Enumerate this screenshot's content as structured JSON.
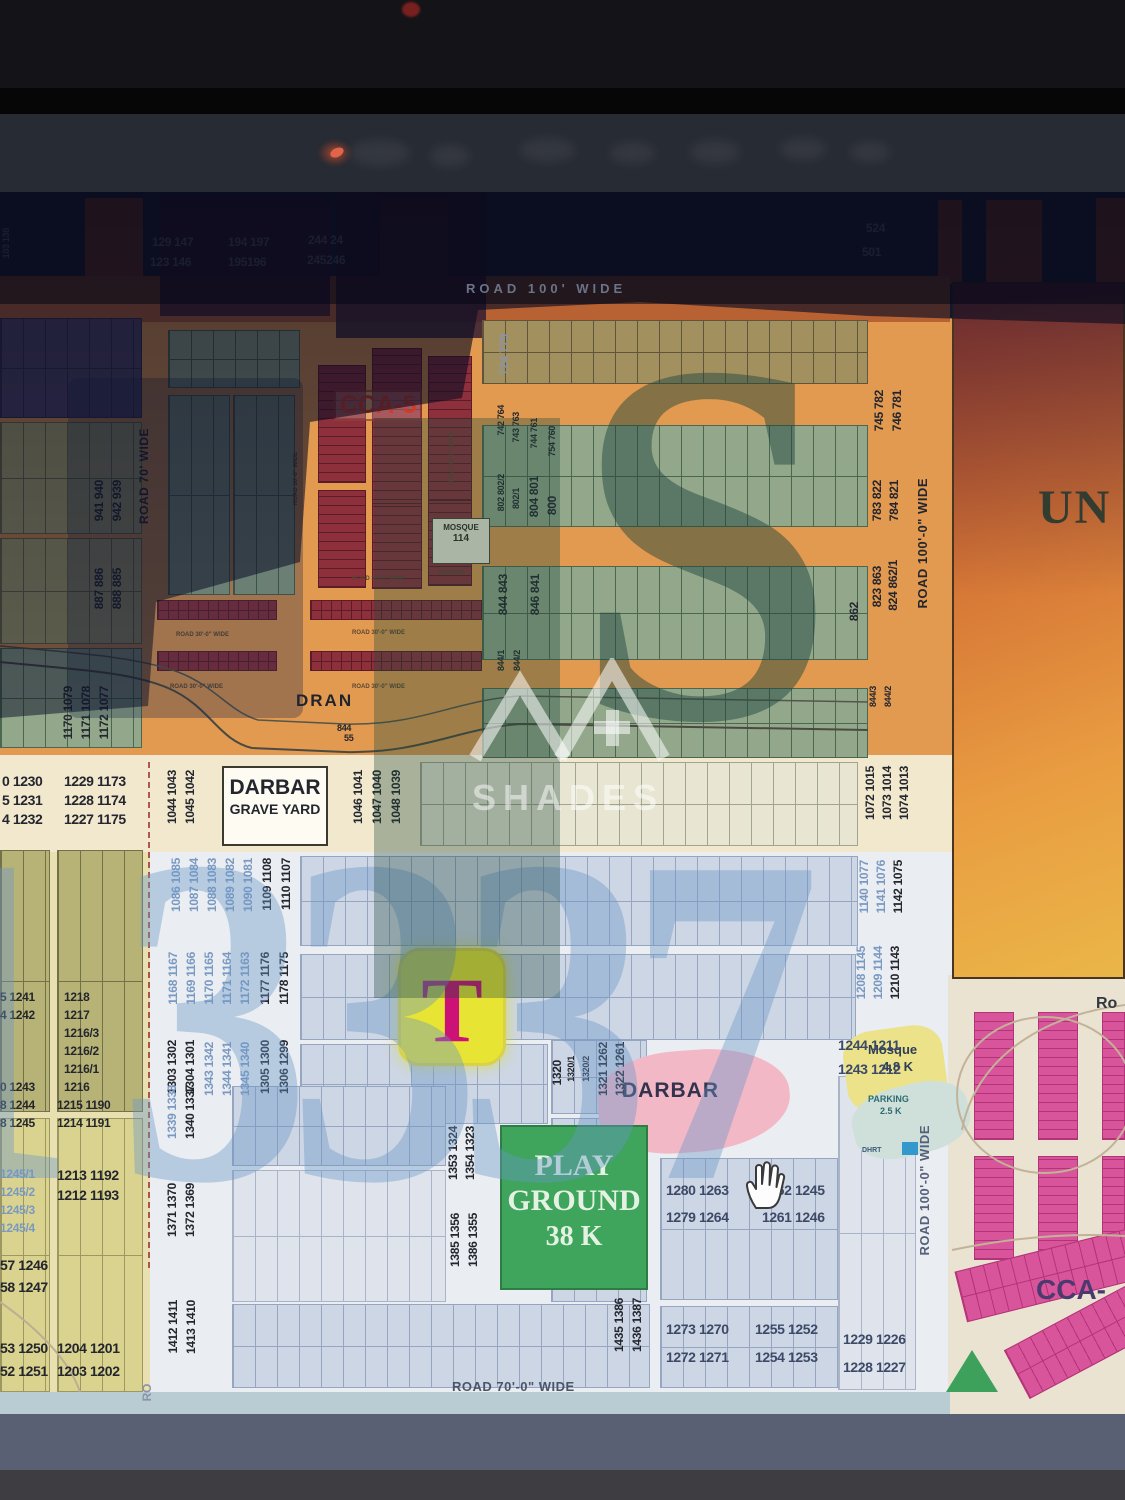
{
  "map": {
    "areas": {
      "cca5": "CCA-5",
      "darbar_box_title": "DARBAR",
      "darbar_box_sub": "GRAVE YARD",
      "dran": "DRAN",
      "playground_l1": "PLAY",
      "playground_l2": "GROUND",
      "playground_l3": "38 K",
      "darbar": "DARBAR",
      "mosque_l1": "Mosque",
      "mosque_l2": "4.8 K",
      "parking_l1": "PARKING",
      "parking_l2": "2.5 K",
      "dhrt": "DHRT",
      "mosque_box_l1": "MOSQUE",
      "mosque_box_l2": "114",
      "mosque_box_sub": "PARKING",
      "un_block": "UN",
      "cca_bottom_right": "CCA-",
      "ro": "Ro",
      "t_marker": "T",
      "small_844": "844",
      "small_55": "55"
    },
    "roads": {
      "top": "ROAD 100' WIDE",
      "left_v": "ROAD 70' WIDE",
      "right_v_upper": "ROAD 100'-0\" WIDE",
      "right_v_lower": "ROAD 100'-0\" WIDE",
      "bottom": "ROAD 70'-0\" WIDE",
      "minor": "ROAD 30'-0\" WIDE"
    },
    "watermark": {
      "big_letter": "S",
      "digits": [
        "1",
        "3",
        "3",
        "3",
        "7"
      ],
      "brand": "SHADES"
    },
    "plot_labels": [
      {
        "t": "129 147",
        "x": 152,
        "y": 236,
        "k": "g"
      },
      {
        "t": "123 146",
        "x": 150,
        "y": 256,
        "k": "g"
      },
      {
        "t": "194 197",
        "x": 228,
        "y": 236,
        "k": "g"
      },
      {
        "t": "195196",
        "x": 228,
        "y": 256,
        "k": "g"
      },
      {
        "t": "244 24",
        "x": 308,
        "y": 234,
        "k": "g"
      },
      {
        "t": "245246",
        "x": 307,
        "y": 254,
        "k": "g"
      },
      {
        "t": "524",
        "x": 866,
        "y": 222,
        "k": "g"
      },
      {
        "t": "501",
        "x": 862,
        "y": 246,
        "k": "g"
      },
      {
        "t": "103 138",
        "x": 2,
        "y": 228,
        "k": "g v S"
      },
      {
        "t": "724 779",
        "x": 498,
        "y": 334,
        "k": "v g"
      },
      {
        "t": "742 764",
        "x": 497,
        "y": 405,
        "k": "v S"
      },
      {
        "t": "743 763",
        "x": 512,
        "y": 412,
        "k": "v S"
      },
      {
        "t": "744 761",
        "x": 530,
        "y": 418,
        "k": "v S"
      },
      {
        "t": "754 760",
        "x": 548,
        "y": 426,
        "k": "v S"
      },
      {
        "t": "745 782",
        "x": 873,
        "y": 390,
        "k": "v"
      },
      {
        "t": "746 781",
        "x": 891,
        "y": 390,
        "k": "v"
      },
      {
        "t": "802 802/2",
        "x": 497,
        "y": 474,
        "k": "v S"
      },
      {
        "t": "802/1",
        "x": 512,
        "y": 488,
        "k": "v S"
      },
      {
        "t": "804 801",
        "x": 528,
        "y": 476,
        "k": "v"
      },
      {
        "t": "800",
        "x": 546,
        "y": 496,
        "k": "v"
      },
      {
        "t": "783 822",
        "x": 871,
        "y": 480,
        "k": "v"
      },
      {
        "t": "784 821",
        "x": 888,
        "y": 480,
        "k": "v"
      },
      {
        "t": "823 863",
        "x": 871,
        "y": 566,
        "k": "v"
      },
      {
        "t": "824 862/1",
        "x": 887,
        "y": 560,
        "k": "v"
      },
      {
        "t": "862",
        "x": 848,
        "y": 602,
        "k": "v"
      },
      {
        "t": "844 843",
        "x": 497,
        "y": 574,
        "k": "v"
      },
      {
        "t": "846 841",
        "x": 529,
        "y": 574,
        "k": "v"
      },
      {
        "t": "844/1",
        "x": 497,
        "y": 650,
        "k": "v S"
      },
      {
        "t": "844/2",
        "x": 513,
        "y": 650,
        "k": "v S"
      },
      {
        "t": "844/3",
        "x": 869,
        "y": 686,
        "k": "v S"
      },
      {
        "t": "844/2",
        "x": 884,
        "y": 686,
        "k": "v S"
      },
      {
        "t": "941 940",
        "x": 93,
        "y": 480,
        "k": "v"
      },
      {
        "t": "942 939",
        "x": 111,
        "y": 480,
        "k": "v"
      },
      {
        "t": "887 886",
        "x": 93,
        "y": 568,
        "k": "v"
      },
      {
        "t": "888 885",
        "x": 111,
        "y": 568,
        "k": "v"
      },
      {
        "t": "1170 1079",
        "x": 62,
        "y": 686,
        "k": "v"
      },
      {
        "t": "1171 1078",
        "x": 80,
        "y": 686,
        "k": "v"
      },
      {
        "t": "1172 1077",
        "x": 98,
        "y": 686,
        "k": "v"
      },
      {
        "t": "1044 1043",
        "x": 166,
        "y": 770,
        "k": "v"
      },
      {
        "t": "1045 1042",
        "x": 184,
        "y": 770,
        "k": "v"
      },
      {
        "t": "1046 1041",
        "x": 352,
        "y": 770,
        "k": "v"
      },
      {
        "t": "1047 1040",
        "x": 371,
        "y": 770,
        "k": "v"
      },
      {
        "t": "1048 1039",
        "x": 390,
        "y": 770,
        "k": "v"
      },
      {
        "t": "1072 1015",
        "x": 864,
        "y": 766,
        "k": "v"
      },
      {
        "t": "1073 1014",
        "x": 881,
        "y": 766,
        "k": "v"
      },
      {
        "t": "1074 1013",
        "x": 898,
        "y": 766,
        "k": "v"
      },
      {
        "t": "844",
        "x": 337,
        "y": 724,
        "k": "S"
      },
      {
        "t": "55",
        "x": 344,
        "y": 734,
        "k": "S"
      },
      {
        "t": "0 1230",
        "x": 2,
        "y": 774,
        "k": "L"
      },
      {
        "t": "5 1231",
        "x": 2,
        "y": 793,
        "k": "L"
      },
      {
        "t": "4 1232",
        "x": 2,
        "y": 812,
        "k": "L"
      },
      {
        "t": "1229 1173",
        "x": 64,
        "y": 774,
        "k": "L"
      },
      {
        "t": "1228 1174",
        "x": 64,
        "y": 793,
        "k": "L"
      },
      {
        "t": "1227 1175",
        "x": 64,
        "y": 812,
        "k": "L"
      },
      {
        "t": "1086 1085",
        "x": 170,
        "y": 858,
        "k": "v numb"
      },
      {
        "t": "1087 1084",
        "x": 188,
        "y": 858,
        "k": "v numb"
      },
      {
        "t": "1088 1083",
        "x": 206,
        "y": 858,
        "k": "v numb"
      },
      {
        "t": "1089 1082",
        "x": 224,
        "y": 858,
        "k": "v numb"
      },
      {
        "t": "1090 1081",
        "x": 242,
        "y": 858,
        "k": "v numb"
      },
      {
        "t": "1109 1108",
        "x": 261,
        "y": 858,
        "k": "v"
      },
      {
        "t": "1110 1107",
        "x": 280,
        "y": 858,
        "k": "v"
      },
      {
        "t": "1140 1077",
        "x": 858,
        "y": 860,
        "k": "v numb"
      },
      {
        "t": "1141 1076",
        "x": 875,
        "y": 860,
        "k": "v numb"
      },
      {
        "t": "1142 1075",
        "x": 892,
        "y": 860,
        "k": "v"
      },
      {
        "t": "1168 1167",
        "x": 167,
        "y": 952,
        "k": "v numb"
      },
      {
        "t": "1169 1166",
        "x": 185,
        "y": 952,
        "k": "v numb"
      },
      {
        "t": "1170 1165",
        "x": 203,
        "y": 952,
        "k": "v numb"
      },
      {
        "t": "1171 1164",
        "x": 221,
        "y": 952,
        "k": "v numb"
      },
      {
        "t": "1172 1163",
        "x": 239,
        "y": 952,
        "k": "v numb"
      },
      {
        "t": "1177 1176",
        "x": 259,
        "y": 952,
        "k": "v"
      },
      {
        "t": "1178 1175",
        "x": 278,
        "y": 952,
        "k": "v"
      },
      {
        "t": "1208 1145",
        "x": 855,
        "y": 946,
        "k": "v numb"
      },
      {
        "t": "1209 1144",
        "x": 872,
        "y": 946,
        "k": "v numb"
      },
      {
        "t": "1210 1143",
        "x": 889,
        "y": 946,
        "k": "v"
      },
      {
        "t": "1303 1302",
        "x": 166,
        "y": 1040,
        "k": "v"
      },
      {
        "t": "1304 1301",
        "x": 184,
        "y": 1040,
        "k": "v"
      },
      {
        "t": "1343 1342",
        "x": 203,
        "y": 1042,
        "k": "v numb"
      },
      {
        "t": "1344 1341",
        "x": 221,
        "y": 1042,
        "k": "v numb"
      },
      {
        "t": "1345 1340",
        "x": 239,
        "y": 1042,
        "k": "v numb"
      },
      {
        "t": "1305 1300",
        "x": 259,
        "y": 1040,
        "k": "v"
      },
      {
        "t": "1306 1299",
        "x": 278,
        "y": 1040,
        "k": "v"
      },
      {
        "t": "1320",
        "x": 551,
        "y": 1060,
        "k": "v"
      },
      {
        "t": "1320/1",
        "x": 567,
        "y": 1056,
        "k": "v S"
      },
      {
        "t": "1320/2",
        "x": 582,
        "y": 1056,
        "k": "v S"
      },
      {
        "t": "1321 1262",
        "x": 597,
        "y": 1042,
        "k": "v"
      },
      {
        "t": "1322 1261",
        "x": 614,
        "y": 1042,
        "k": "v"
      },
      {
        "t": "1244 1211",
        "x": 838,
        "y": 1038,
        "k": "s L"
      },
      {
        "t": "1243 1212",
        "x": 838,
        "y": 1062,
        "k": "s L"
      },
      {
        "t": "1339 1338",
        "x": 166,
        "y": 1085,
        "k": "v numb"
      },
      {
        "t": "1340 1337",
        "x": 184,
        "y": 1085,
        "k": "v"
      },
      {
        "t": "1353 1324",
        "x": 447,
        "y": 1126,
        "k": "v"
      },
      {
        "t": "1354 1323",
        "x": 464,
        "y": 1126,
        "k": "v"
      },
      {
        "t": "1280 1263",
        "x": 666,
        "y": 1183,
        "k": "s L"
      },
      {
        "t": "1279 1264",
        "x": 666,
        "y": 1210,
        "k": "s L"
      },
      {
        "t": "1262 1245",
        "x": 762,
        "y": 1183,
        "k": "s L"
      },
      {
        "t": "1261 1246",
        "x": 762,
        "y": 1210,
        "k": "s L"
      },
      {
        "t": "1371 1370",
        "x": 166,
        "y": 1183,
        "k": "v"
      },
      {
        "t": "1372 1369",
        "x": 184,
        "y": 1183,
        "k": "v"
      },
      {
        "t": "1385 1356",
        "x": 449,
        "y": 1213,
        "k": "v"
      },
      {
        "t": "1386 1355",
        "x": 467,
        "y": 1213,
        "k": "v"
      },
      {
        "t": "1412 1411",
        "x": 167,
        "y": 1300,
        "k": "v"
      },
      {
        "t": "1413 1410",
        "x": 185,
        "y": 1300,
        "k": "v"
      },
      {
        "t": "1435 1386",
        "x": 613,
        "y": 1298,
        "k": "v"
      },
      {
        "t": "1436 1387",
        "x": 631,
        "y": 1298,
        "k": "v"
      },
      {
        "t": "1273 1270",
        "x": 666,
        "y": 1322,
        "k": "s L"
      },
      {
        "t": "1272 1271",
        "x": 666,
        "y": 1350,
        "k": "s L"
      },
      {
        "t": "1255 1252",
        "x": 755,
        "y": 1322,
        "k": "s L"
      },
      {
        "t": "1254 1253",
        "x": 755,
        "y": 1350,
        "k": "s L"
      },
      {
        "t": "1229 1226",
        "x": 843,
        "y": 1332,
        "k": "s L"
      },
      {
        "t": "1228 1227",
        "x": 843,
        "y": 1360,
        "k": "s L"
      },
      {
        "t": "1218",
        "x": 64,
        "y": 991
      },
      {
        "t": "1217",
        "x": 64,
        "y": 1009
      },
      {
        "t": "1216/3",
        "x": 64,
        "y": 1027
      },
      {
        "t": "1216/2",
        "x": 64,
        "y": 1045
      },
      {
        "t": "1216/1",
        "x": 64,
        "y": 1063
      },
      {
        "t": "1216",
        "x": 64,
        "y": 1081
      },
      {
        "t": "1215 1190",
        "x": 57,
        "y": 1099
      },
      {
        "t": "1214 1191",
        "x": 57,
        "y": 1117
      },
      {
        "t": "1213 1192",
        "x": 57,
        "y": 1168,
        "k": "L"
      },
      {
        "t": "1212 1193",
        "x": 57,
        "y": 1188,
        "k": "L"
      },
      {
        "t": "1204 1201",
        "x": 57,
        "y": 1341,
        "k": "L"
      },
      {
        "t": "1203 1202",
        "x": 57,
        "y": 1364,
        "k": "L"
      },
      {
        "t": "5 1241",
        "x": 0,
        "y": 991
      },
      {
        "t": "4 1242",
        "x": 0,
        "y": 1009
      },
      {
        "t": "0 1243",
        "x": 0,
        "y": 1081
      },
      {
        "t": "8 1244",
        "x": 0,
        "y": 1099
      },
      {
        "t": "8 1245",
        "x": 0,
        "y": 1117
      },
      {
        "t": "1245/1",
        "x": 0,
        "y": 1168,
        "k": "numb"
      },
      {
        "t": "1245/2",
        "x": 0,
        "y": 1186,
        "k": "numb"
      },
      {
        "t": "1245/3",
        "x": 0,
        "y": 1204,
        "k": "numb"
      },
      {
        "t": "1245/4",
        "x": 0,
        "y": 1222,
        "k": "numb"
      },
      {
        "t": "57 1246",
        "x": 0,
        "y": 1258,
        "k": "L"
      },
      {
        "t": "58 1247",
        "x": 0,
        "y": 1280,
        "k": "L"
      },
      {
        "t": "53 1250",
        "x": 0,
        "y": 1341,
        "k": "L"
      },
      {
        "t": "52 1251",
        "x": 0,
        "y": 1364,
        "k": "L"
      },
      {
        "t": "RO",
        "x": 141,
        "y": 1384,
        "k": "v g"
      }
    ]
  }
}
